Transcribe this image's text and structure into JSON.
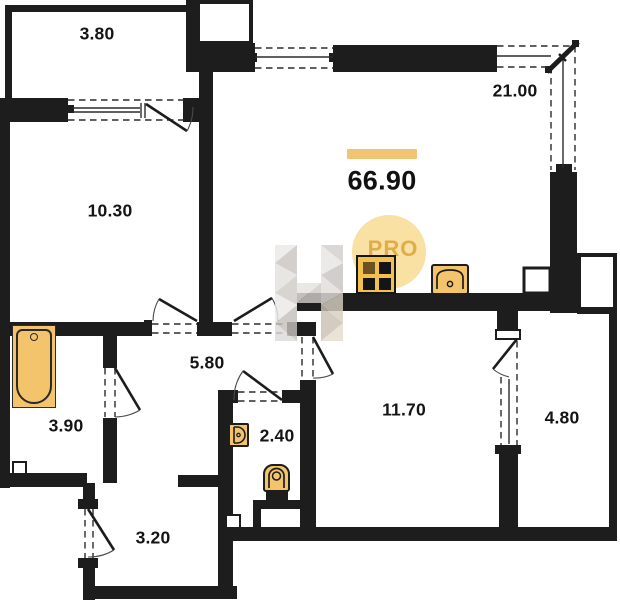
{
  "floor_plan": {
    "type": "apartment-floor-plan",
    "total_area": "66.90",
    "rooms": [
      {
        "id": "balcony-top",
        "area_label": "3.80"
      },
      {
        "id": "room-left",
        "area_label": "10.30"
      },
      {
        "id": "living-kitchen",
        "area_label": "21.00"
      },
      {
        "id": "hallway",
        "area_label": "5.80"
      },
      {
        "id": "bathroom",
        "area_label": "3.90"
      },
      {
        "id": "wc",
        "area_label": "2.40"
      },
      {
        "id": "room-right",
        "area_label": "11.70"
      },
      {
        "id": "balcony-right",
        "area_label": "4.80"
      },
      {
        "id": "entry-hall",
        "area_label": "3.20"
      }
    ],
    "fixtures": [
      "bathtub",
      "kitchen-stove",
      "kitchen-sink",
      "washbasin",
      "toilet"
    ],
    "watermark": {
      "letter": "H",
      "pro_text": "PRO"
    },
    "colors": {
      "wall": "#1d1d1d",
      "fixture_fill": "#f3c46b",
      "stove_fill": "#f1c04f",
      "accent_bar": "#f0c472",
      "pro_circle": "#f7d88c",
      "pro_text": "#dfab44",
      "watermark_gray": "#d6d2ce"
    }
  }
}
